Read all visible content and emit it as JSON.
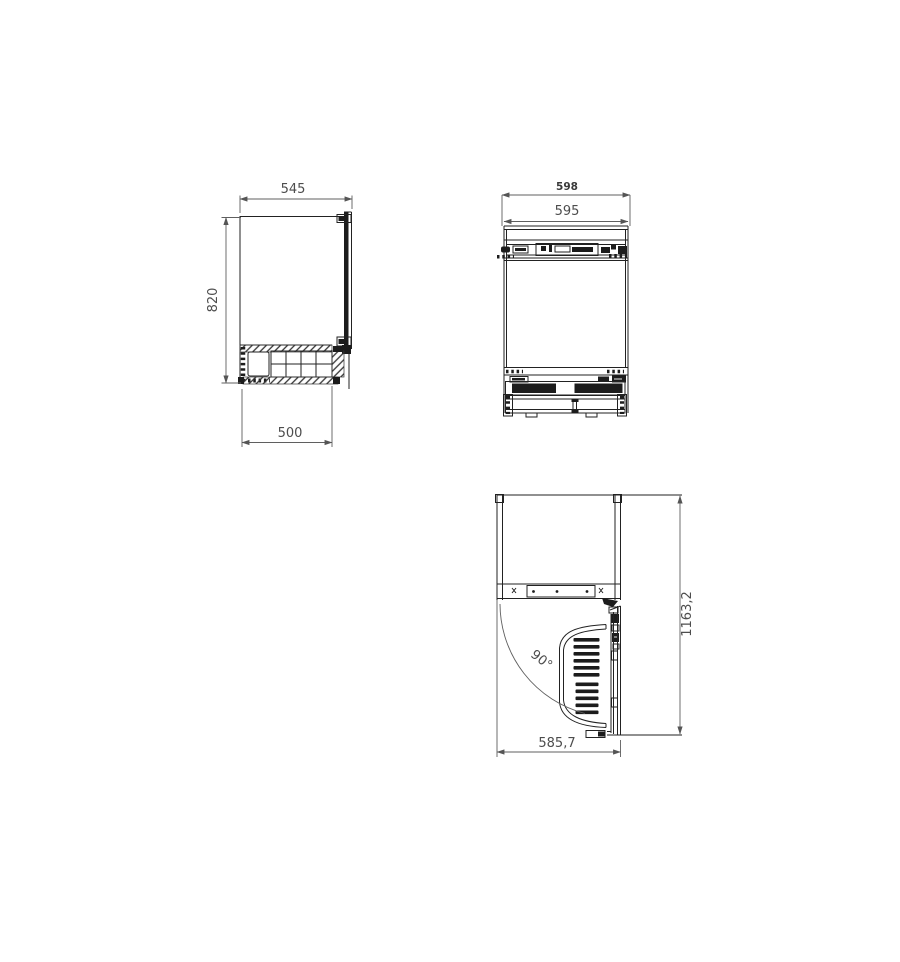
{
  "drawing_type": "appliance installation technical drawing",
  "colors": {
    "background": "#ffffff",
    "line": "#222222",
    "dim_line": "#5f5f5f",
    "dim_text": "#4d4d4d",
    "fill_dark": "#1c1c1c"
  },
  "views": {
    "side": {
      "dims": {
        "depth_top": "545",
        "height": "820",
        "base_depth": "500"
      }
    },
    "front": {
      "dims": {
        "niche_width": "598",
        "appliance_width": "595"
      }
    },
    "plan": {
      "dims": {
        "total_depth_door_open": "1163,2",
        "depth_to_door_front": "585,7",
        "door_opening_angle": "90°"
      }
    }
  }
}
